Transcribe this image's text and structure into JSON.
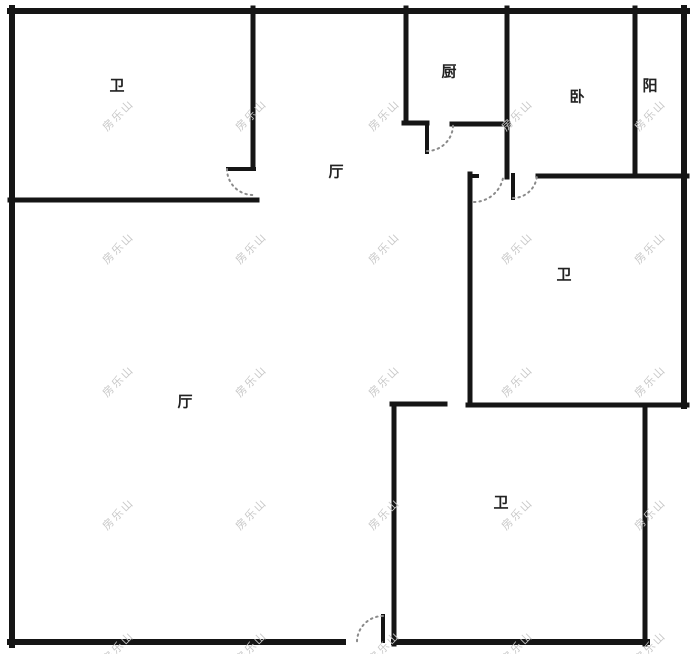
{
  "plan": {
    "type": "floor-plan",
    "rooms": [
      {
        "name": "bathroom-top-left",
        "label": "卫"
      },
      {
        "name": "kitchen",
        "label": "厨"
      },
      {
        "name": "bedroom",
        "label": "卧"
      },
      {
        "name": "balcony",
        "label": "阳"
      },
      {
        "name": "hall-upper",
        "label": "厅"
      },
      {
        "name": "bathroom-mid-right",
        "label": "卫"
      },
      {
        "name": "hall-main",
        "label": "厅"
      },
      {
        "name": "bathroom-bottom",
        "label": "卫"
      }
    ],
    "watermark": {
      "text": "房乐山",
      "color": "#c8c8c8",
      "cols": [
        118,
        251,
        384,
        517,
        650
      ],
      "rows": [
        115,
        248,
        381,
        514,
        647
      ]
    },
    "colors": {
      "wall": "#151515",
      "door_arc": "#8a8a8a",
      "label": "#222222",
      "background": "#ffffff"
    }
  }
}
